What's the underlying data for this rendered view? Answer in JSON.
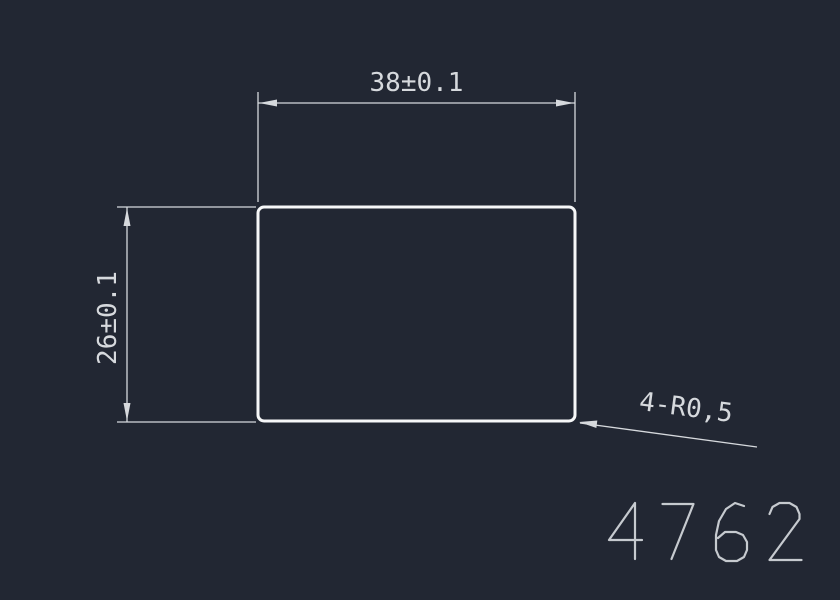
{
  "canvas": {
    "colors": {
      "background": "#222733",
      "geometry": "#f6f7f8",
      "dimension": "#d6d9dd",
      "part_number": "#c6cacf"
    }
  },
  "drawing": {
    "type": "2d-part-drawing",
    "part_outline": {
      "shape": "rounded-rectangle"
    },
    "dimensions": {
      "width": {
        "label": "38±0.1",
        "value": 38,
        "tolerance": "±0.1"
      },
      "height": {
        "label": "26±0.1",
        "value": 26,
        "tolerance": "±0.1"
      }
    },
    "leader_note": {
      "label": "4-R0,5",
      "count": 4,
      "radius": "R0,5"
    },
    "part_number": "4762"
  }
}
